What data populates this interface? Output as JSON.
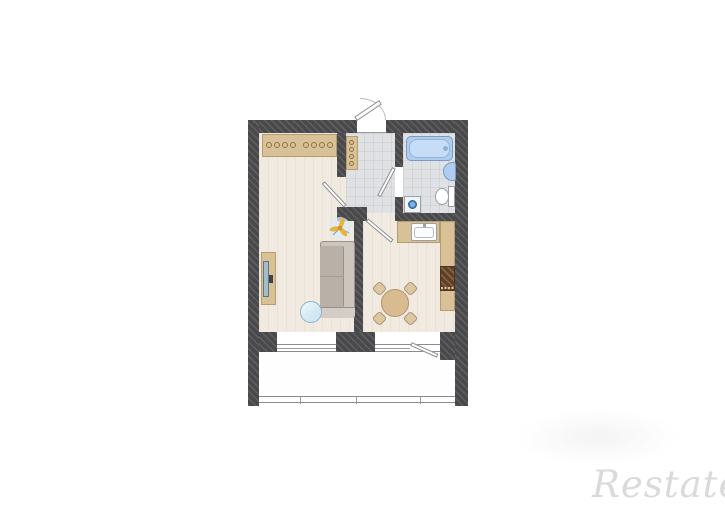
{
  "canvas": {
    "width": 725,
    "height": 512,
    "background": "#ffffff"
  },
  "watermark": {
    "brand_text": "Restate",
    "color": "#dadada"
  },
  "palette": {
    "wall": "#49494b",
    "wood_floor": "#f1eae1",
    "tile_floor": "#dfe1e4",
    "cabinet_tan": "#d9c197",
    "water_blue": "#aecdf0",
    "sofa_gray": "#cdc6bf",
    "dining_table_wood": "#d9bb91",
    "stove_brown": "#6e4f39",
    "appliance_door_blue": "#4a86c8",
    "door_leaf": "#fdfdfd"
  },
  "plan": {
    "type": "apartment-floor-plan",
    "rooms": [
      "hallway",
      "bathroom",
      "living-room",
      "kitchen",
      "balcony"
    ],
    "fixtures": [
      "entry-door",
      "wardrobe-with-hangers",
      "hall-wardrobe",
      "bathtub",
      "wall-sink",
      "toilet",
      "washing-machine",
      "tv-stand",
      "tv",
      "sofa",
      "coffee-table",
      "ceiling-light",
      "kitchen-counter",
      "kitchen-sink",
      "stove",
      "dining-table",
      "dining-chairs",
      "living-room-window",
      "kitchen-window",
      "balcony-door",
      "balcony-glazing"
    ]
  }
}
